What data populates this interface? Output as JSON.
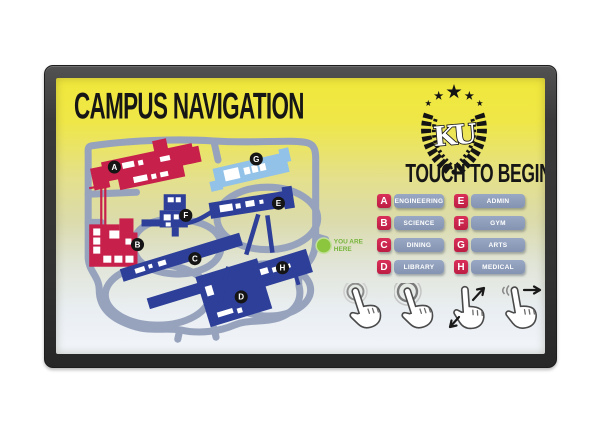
{
  "screen": {
    "title": "CAMPUS NAVIGATION",
    "cta": "TOUCH TO BEGIN",
    "logo": {
      "monogram": "KU"
    },
    "map": {
      "markers": [
        "A",
        "B",
        "C",
        "D",
        "E",
        "F",
        "G",
        "H"
      ],
      "you_are_here": {
        "line1": "YOU ARE",
        "line2": "HERE"
      }
    },
    "legend": {
      "items": [
        {
          "key": "A",
          "label": "ENGINEERING"
        },
        {
          "key": "B",
          "label": "SCIENCE"
        },
        {
          "key": "C",
          "label": "DINING"
        },
        {
          "key": "D",
          "label": "LIBRARY"
        },
        {
          "key": "E",
          "label": "ADMIN"
        },
        {
          "key": "F",
          "label": "GYM"
        },
        {
          "key": "G",
          "label": "ARTS"
        },
        {
          "key": "H",
          "label": "MEDICAL"
        }
      ]
    },
    "gestures": [
      {
        "name": "tap"
      },
      {
        "name": "double-tap"
      },
      {
        "name": "pinch-zoom"
      },
      {
        "name": "swipe-right"
      }
    ],
    "colors": {
      "screen_top_yellow": "#f1e83b",
      "building_red": "#c7204b",
      "building_blue": "#2d3f98",
      "building_light_blue": "#92c2e8",
      "road_gray": "#97a3bd",
      "legend_pill": "#8f9eba",
      "legend_key_red": "#c5214a",
      "you_are_here_green": "#8cc63e",
      "bezel_gray": "#3a3a3a"
    }
  }
}
